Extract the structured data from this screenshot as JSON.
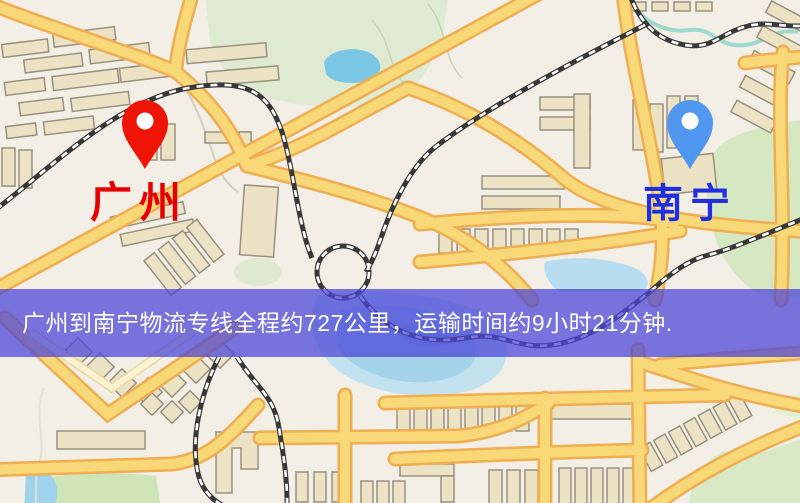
{
  "map": {
    "origin": {
      "label": "广州",
      "label_color": "#e60000",
      "pin_icon": "map-pin",
      "pin_color": "#ee1507"
    },
    "destination": {
      "label": "南宁",
      "label_color": "#2030dd",
      "pin_icon": "map-pin",
      "pin_color": "#4f97ef"
    },
    "banner": {
      "text": "广州到南宁物流专线全程约727公里，运输时间约9小时21分钟.",
      "background": "#4c46d8",
      "text_color": "#ffffff",
      "route_distance": "约727公里",
      "route_duration": "约9小时21分钟"
    },
    "legend_colors": {
      "road": "#f9d878",
      "road_casing": "#efae52",
      "building": "#ebe3c4",
      "park": "#d6e8c2",
      "water": "#a4d4ea",
      "railway": "#383838"
    }
  }
}
